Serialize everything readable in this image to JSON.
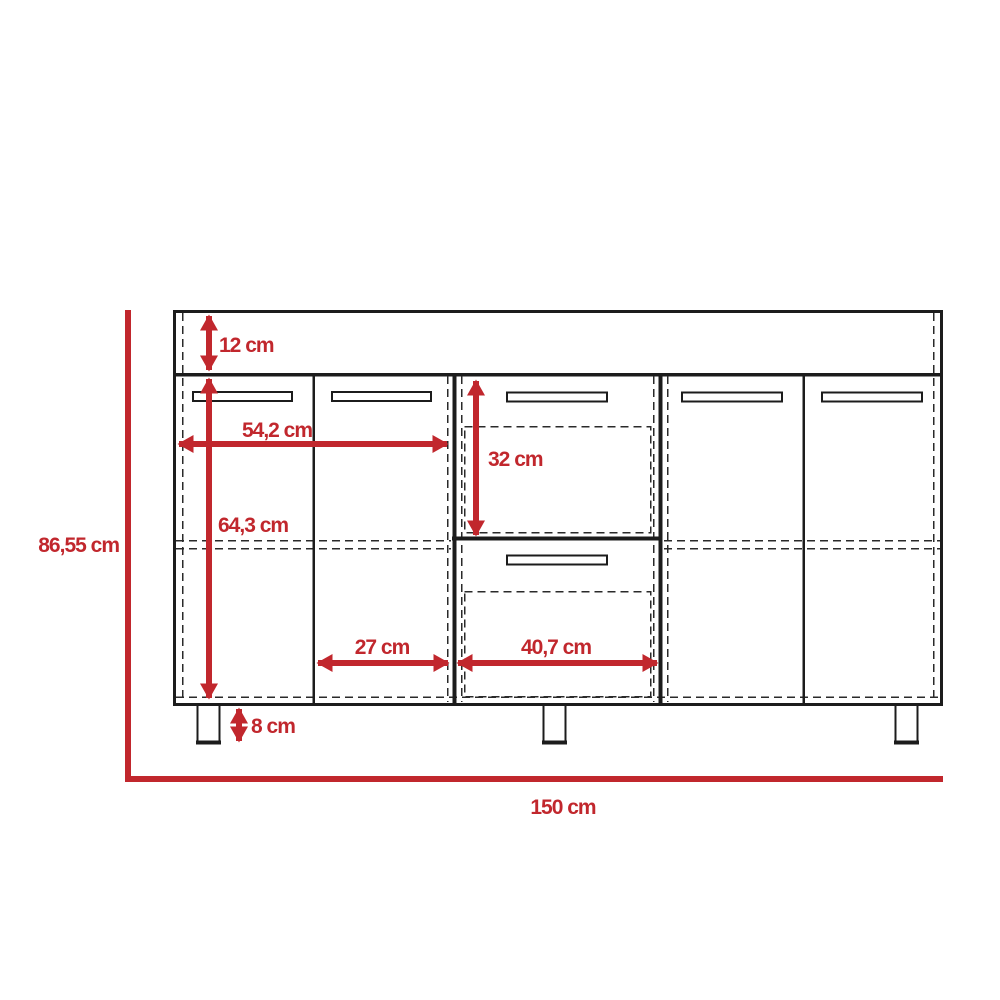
{
  "diagram": {
    "title": "cabinet-dimension-diagram",
    "unit": "cm",
    "colors": {
      "dimension_red": "#C1272D",
      "line_black": "#1c1c1c",
      "background": "#ffffff"
    },
    "overall": {
      "total_height": "86,55 cm",
      "total_width": "150 cm"
    },
    "dimensions": {
      "top_panel_height": "12 cm",
      "left_section_width": "54,2 cm",
      "drawer_opening_height": "32 cm",
      "door_height": "64,3 cm",
      "door_width": "27 cm",
      "drawer_width": "40,7 cm",
      "leg_height": "8 cm"
    }
  }
}
